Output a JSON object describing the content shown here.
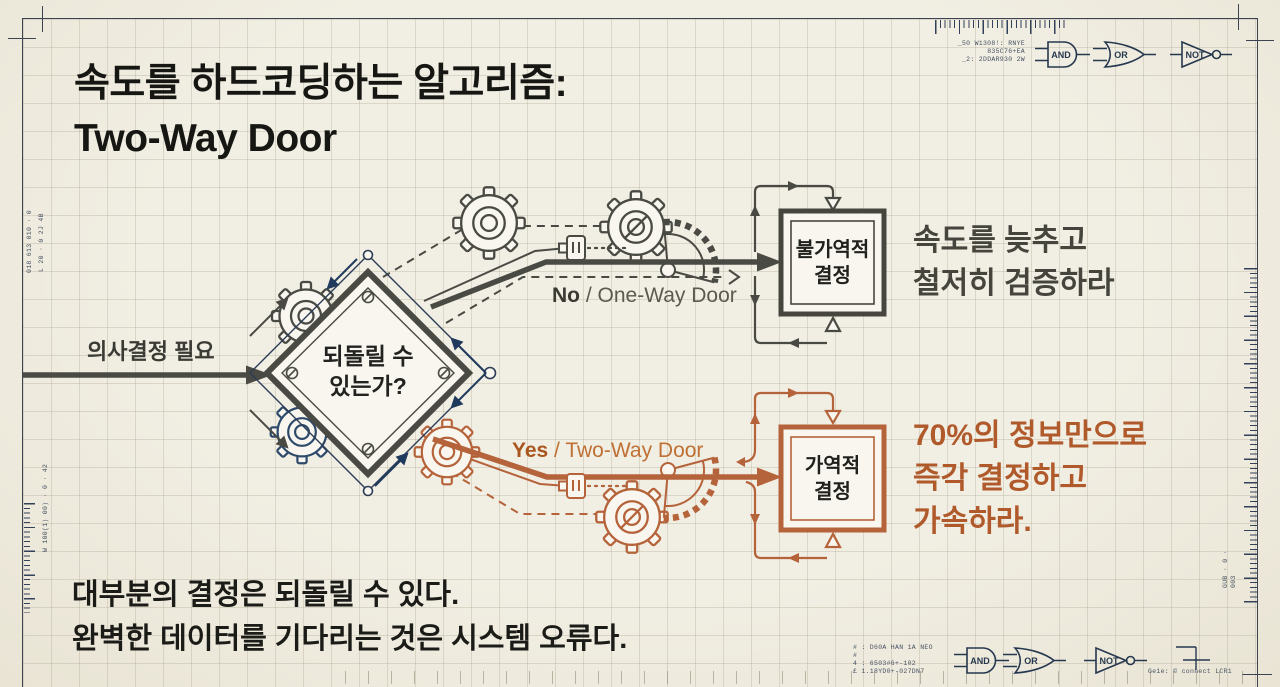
{
  "title": {
    "line1": "속도를 하드코딩하는 알고리즘:",
    "line2": "Two-Way Door"
  },
  "flow": {
    "input_label": "의사결정 필요",
    "decision": {
      "line1": "되돌릴 수",
      "line2": "있는가?"
    },
    "no_branch": {
      "label_bold": "No",
      "label_rest": " / One-Way Door",
      "box_line1": "불가역적",
      "box_line2": "결정",
      "note_line1": "속도를 늦추고",
      "note_line2": "철저히 검증하라"
    },
    "yes_branch": {
      "label_bold": "Yes",
      "label_rest": " / Two-Way Door",
      "box_line1": "가역적",
      "box_line2": "결정",
      "note_line1": "70%의 정보만으로",
      "note_line2": "즉각 결정하고",
      "note_line3": "가속하라."
    }
  },
  "footer": {
    "line1": "대부분의 결정은 되돌릴 수 있다.",
    "line2": "완벽한 데이터를 기다리는 것은 시스템 오류다."
  },
  "gates": {
    "and": "AND",
    "or": "OR",
    "not": "NOT"
  },
  "margin_notes": {
    "top_right": [
      "_50 W1308!: RNYE",
      "835C76+EA",
      "_2: 2DDAR930 2W"
    ],
    "bottom_mid": [
      "# : D60A HAN 1A NEO",
      "#",
      "4 : 6503#6+-102",
      "£ 1.18YD0+-027DN7"
    ],
    "bottom_right_label": "Ge1e:  © connect LCR1",
    "left_upper_1": "018 613 010 · 0",
    "left_upper_2": "L 20 · 0 2J 4B",
    "left_lower": "W 100(1) 00) · 0 · 42",
    "right_lower": "GUB · 0 · 003"
  },
  "palette": {
    "ink": "#4a4a44",
    "accent_orange": "#b5633a",
    "navy": "#26384f",
    "paper": "#f1eee3"
  }
}
